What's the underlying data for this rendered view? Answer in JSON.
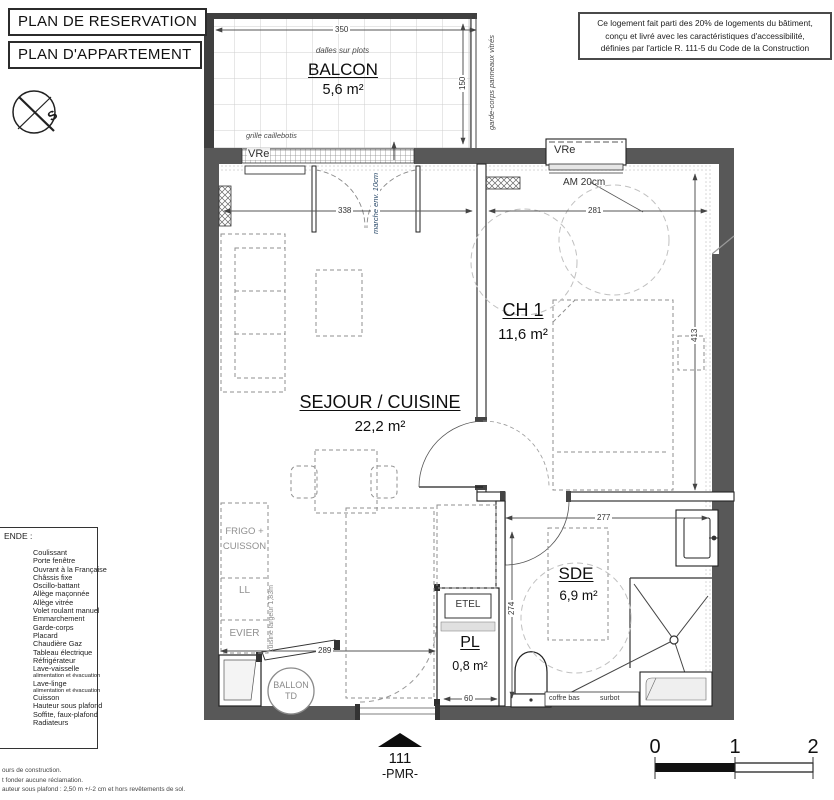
{
  "titles": {
    "reservation": "PLAN DE RESERVATION",
    "apartment": "PLAN D'APPARTEMENT"
  },
  "compass": {
    "south": "S"
  },
  "accessibility_note": {
    "line1": "Ce logement fait parti des 20% de logements du bâtiment,",
    "line2": "conçu et livré avec les caractéristiques d'accessibilité,",
    "line3": "définies par l'article R. 111-5 du Code de la Construction"
  },
  "rooms": {
    "balcon": {
      "name": "BALCON",
      "area": "5,6 m²"
    },
    "sejour": {
      "name": "SEJOUR / CUISINE",
      "area": "22,2 m²"
    },
    "ch1": {
      "name": "CH 1",
      "area": "11,6 m²"
    },
    "sde": {
      "name": "SDE",
      "area": "6,9 m²"
    },
    "pl": {
      "name": "PL",
      "area": "0,8 m²"
    }
  },
  "labels": {
    "dalles_sur_plots": "dalles sur plots",
    "grille_caillebotis": "grille caillebotis",
    "garde_corps": "garde-corps panneaux vitrés",
    "marche": "marche env. 10cm",
    "vre": "VRe",
    "am20": "AM 20cm",
    "etel": "ETEL",
    "frigo_l1": "FRIGO +",
    "frigo_l2": "CUISSON",
    "ll": "LL",
    "evier": "EVIER",
    "cuisine_largeur": "cuisine largeur 1,83m",
    "ballon_l1": "BALLON",
    "ballon_l2": "TD",
    "coffre_bas": "coffre bas",
    "surbot": "surbot"
  },
  "dimensions": {
    "balcony_width": "350",
    "balcony_depth": "150",
    "sejour_width": "338",
    "ch1_width": "281",
    "ch1_depth": "413",
    "sde_width": "277",
    "entry_depth": "274",
    "kitchen_width": "289",
    "pl_width": "60"
  },
  "legend": {
    "title": "ENDE :",
    "items": [
      "Coulissant",
      "Porte fenêtre",
      "Ouvrant à la Française",
      "Châssis fixe",
      "Oscillo-battant",
      "Allège maçonnée",
      "Allège vitrée",
      "Volet roulant manuel",
      "Emmarchement",
      "Garde-corps",
      "Placard",
      "Chaudière Gaz",
      "Tableau électrique",
      "Réfrigérateur",
      "Lave-vaisselle",
      "alimentation et évacuation",
      "Lave-linge",
      "alimentation et évacuation",
      "Cuisson",
      "Hauteur sous plafond",
      "Soffite, faux-plafond",
      "Radiateurs"
    ]
  },
  "entrance": {
    "lot_number": "111",
    "pmr": "-PMR-"
  },
  "scale_bar": {
    "t0": "0",
    "t1": "1",
    "t2": "2"
  },
  "fine_print": {
    "line1": "ours de construction.",
    "line2": "t fonder aucune réclamation.",
    "line3": "auteur sous plafond : 2,50 m +/-2 cm et hors revêtements de sol."
  },
  "colors": {
    "wall": "#585858",
    "dashed_furniture": "#8f8f8f",
    "turning_circle": "#c0c0c0"
  }
}
